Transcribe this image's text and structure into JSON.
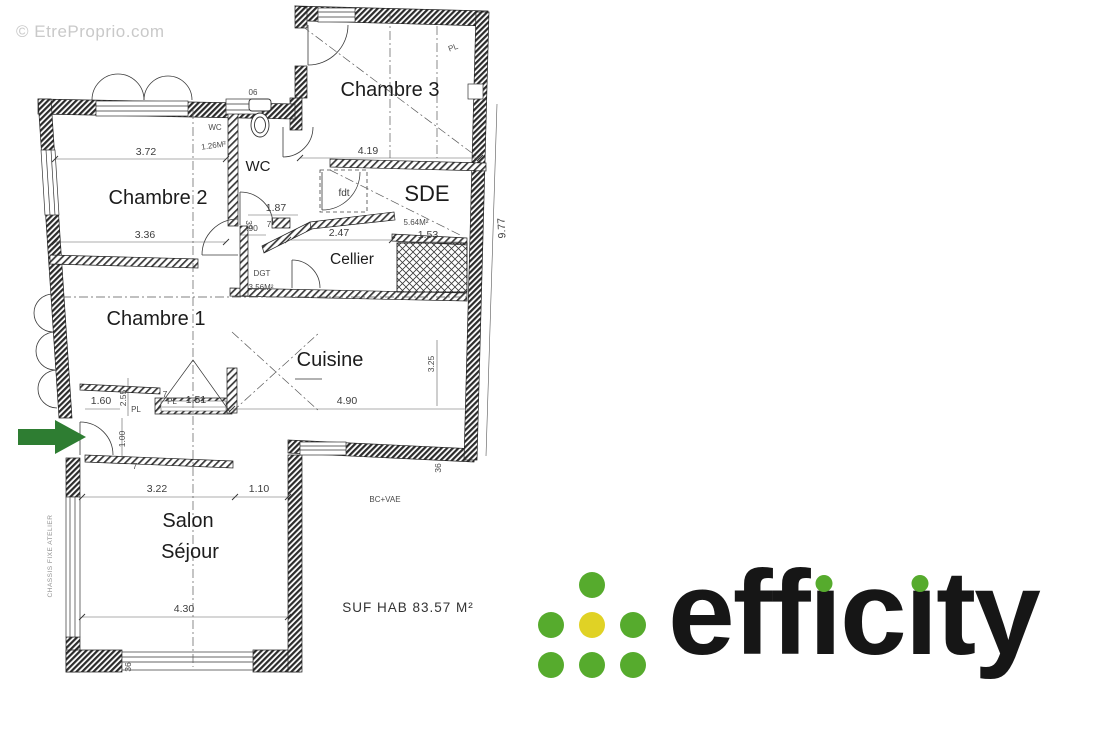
{
  "watermark": "© EtreProprio.com",
  "plan": {
    "rooms": {
      "chambre3": "Chambre 3",
      "chambre2": "Chambre 2",
      "chambre1": "Chambre 1",
      "cuisine": "Cuisine",
      "salon_line1": "Salon",
      "salon_line2": "Séjour",
      "cellier": "Cellier",
      "sde": "SDE",
      "wc_label": "WC",
      "dgt": "DGT",
      "fdt": "fdt"
    },
    "areas": {
      "wc": "1.26M²",
      "dgt": "3.56M²",
      "sde": "5.64M²",
      "total": "SUF HAB 83.57 M²"
    },
    "dimensions": {
      "c3_width": "4.19",
      "c2_top": "3.72",
      "c2_bottom": "3.36",
      "wc_pass": "1.87",
      "wc_w": ".90",
      "cellier_w": "2.47",
      "sde_w": "1.53",
      "cuisine_w": "4.90",
      "cuisine_d": "3.25",
      "house_d": "9.77",
      "salon_a": "3.22",
      "salon_b": "1.10",
      "salon_w": "4.30",
      "entry_a": "1.60",
      "entry_b": "1.00",
      "c1_d": "2.55",
      "closet_w": "1.51",
      "small7": "7",
      "small32": "32",
      "small36": "36",
      "tag06": "06"
    },
    "labels": {
      "pl": "PL",
      "bc_vae": "BC+VAE",
      "chassis": "CHASSIS FIXE ATELIER"
    }
  },
  "logo": {
    "text": "efficity",
    "colors": {
      "green": "#56ab2d",
      "yellow": "#e0d225",
      "text": "#161616"
    }
  },
  "colors": {
    "arrow": "#2e7d32",
    "watermark": "#c9c9c9",
    "wall": "#2b2b2b"
  }
}
